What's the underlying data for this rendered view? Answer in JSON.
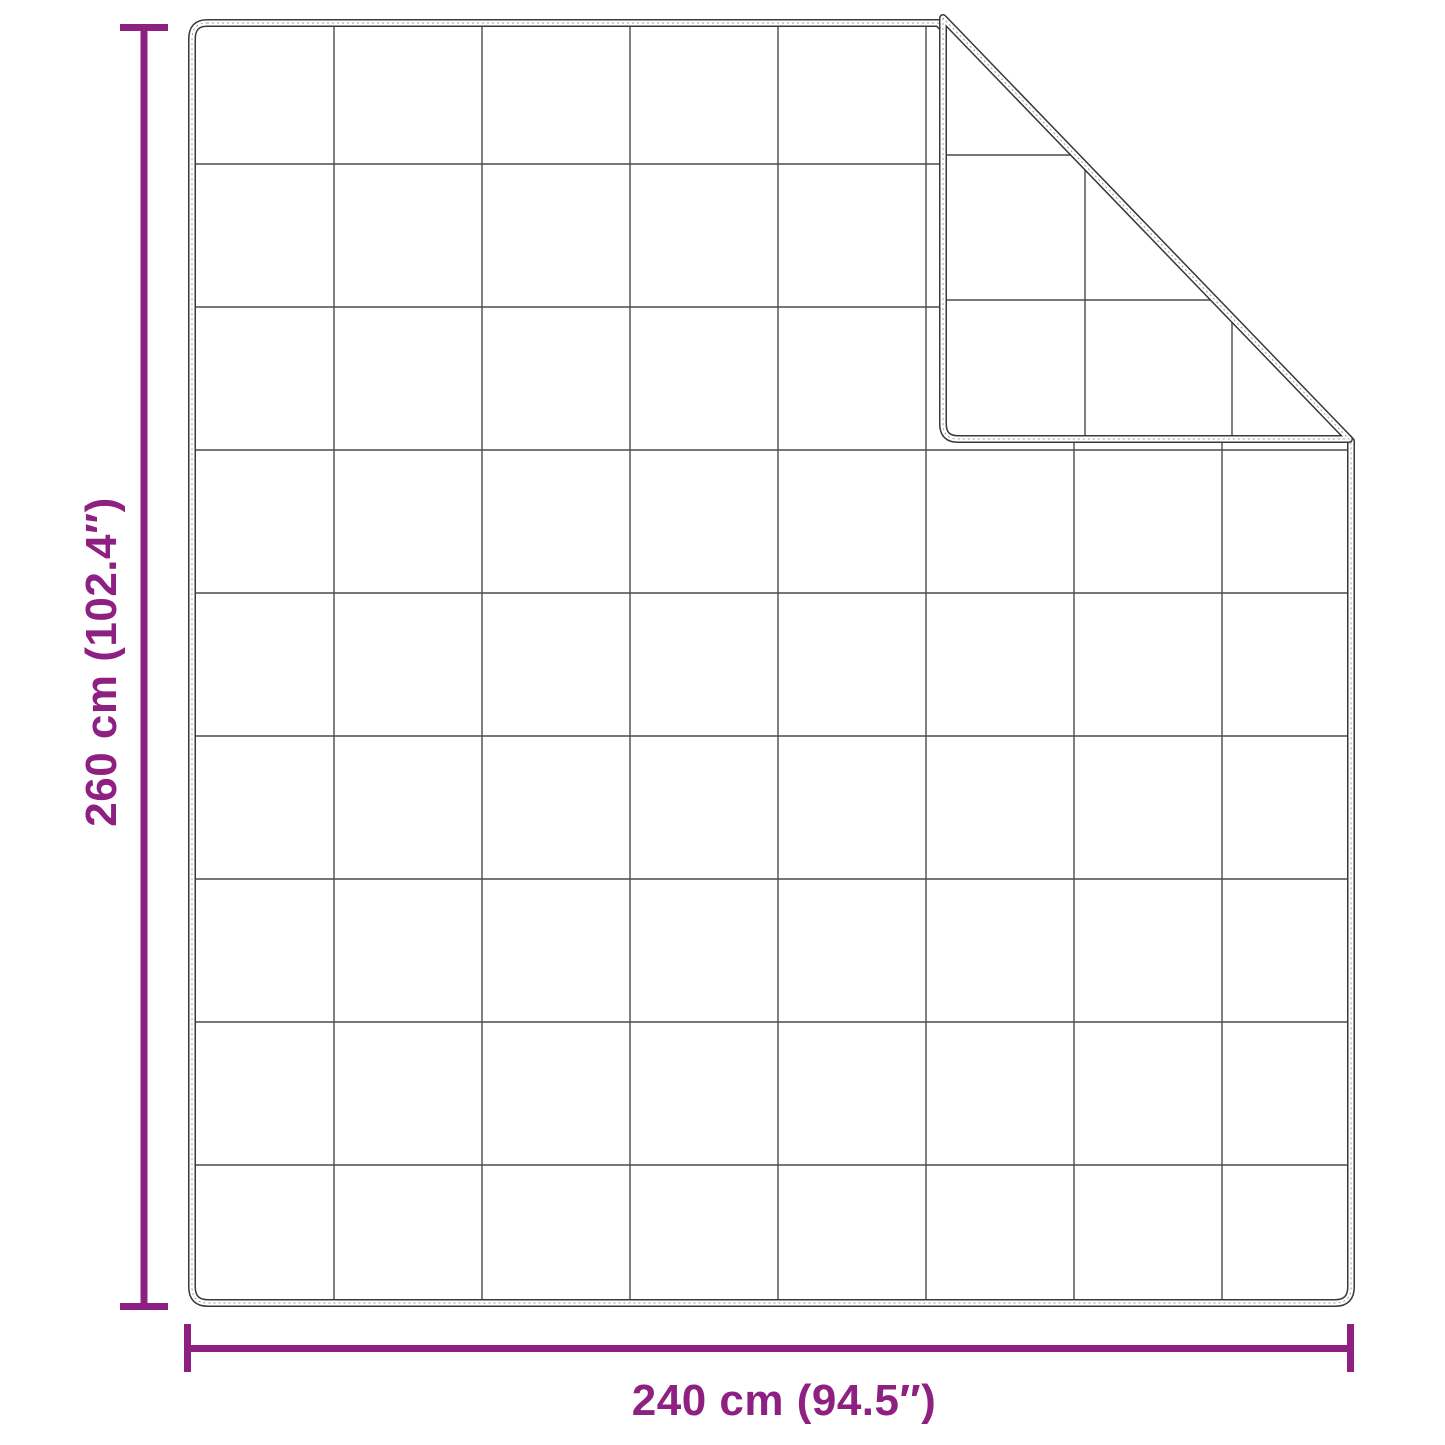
{
  "diagram": {
    "type": "product-dimension-diagram",
    "subject": "quilted weighted blanket, flat view, top-right corner folded over showing reverse side",
    "height_label": "260 cm (102.4″)",
    "width_label": "240 cm (94.5″)",
    "height_value_cm": 260,
    "height_value_inches": 102.4,
    "width_value_cm": 240,
    "width_value_inches": 94.5,
    "grid": {
      "columns": 8,
      "rows": 9,
      "flap_visible_cells": "partial quilt grid on folded flap underside"
    },
    "fold": {
      "corner": "top-right",
      "crease": "diagonal from top edge to right edge"
    },
    "colors": {
      "accent": "#8e2082",
      "outline": "#383838",
      "grid_line": "#4a4a4a",
      "background": "#ffffff"
    }
  }
}
